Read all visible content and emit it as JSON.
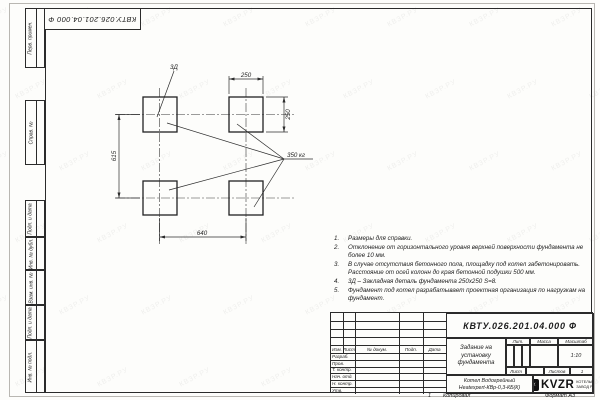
{
  "sheet": {
    "fold_doc_number": "КВТУ.026.201.04.000 Ф",
    "watermark_text": "КВЗР.РУ"
  },
  "side_stamps": [
    "Перв. примен.",
    "Справ. №",
    "Подп. и дата",
    "Инв. № дубл.",
    "Взам. инв. №",
    "Подп. и дата",
    "Инв. № подл."
  ],
  "drawing": {
    "dim_top": "250",
    "dim_right": "250",
    "dim_left": "615",
    "dim_bottom": "640",
    "detail_label": "3Д",
    "load_label": "350 кг"
  },
  "notes": [
    {
      "n": "1.",
      "t": "Размеры для справки."
    },
    {
      "n": "2.",
      "t": "Отклонение от горизонтального уровня верхней поверхности фундамента не более 10 мм."
    },
    {
      "n": "3.",
      "t": "В случае отсутствия бетонного пола, площадку под котел забетонировать. Расстояние от осей колонн до края бетонной подушки 500 мм."
    },
    {
      "n": "4.",
      "t": "3Д – Закладная деталь фундамента 250х250 S=8."
    },
    {
      "n": "5.",
      "t": "Фундамент под котел разрабатывает проектная организация по нагрузкам на фундамент."
    }
  ],
  "title_block": {
    "doc_number": "КВТУ.026.201.04.000 Ф",
    "title": "Задание на установку фундамента",
    "cols": [
      "Изм.",
      "Лист",
      "№ докум.",
      "Подп.",
      "Дата"
    ],
    "rows": [
      "Разраб.",
      "Пров.",
      "Т. контр.",
      "Нач. отд.",
      "Н. контр.",
      "Утв."
    ],
    "lit": "Лит.",
    "mass": "Масса",
    "scale": "Масштаб",
    "scale_value": "1:10",
    "sheet": "Лист",
    "sheets": "Листов",
    "sheets_value": "1",
    "product_line1": "Котел Водогрейный",
    "product_line2": "Heatexpert-КВр-0,3-КБ(К)",
    "logo": "KVZR",
    "logo_sub1": "КОТЕЛЬНЫЙ",
    "logo_sub2": "ЗАВОД РЭП",
    "copied": "Копировал",
    "format": "Формат А3",
    "footer_num": "1"
  }
}
